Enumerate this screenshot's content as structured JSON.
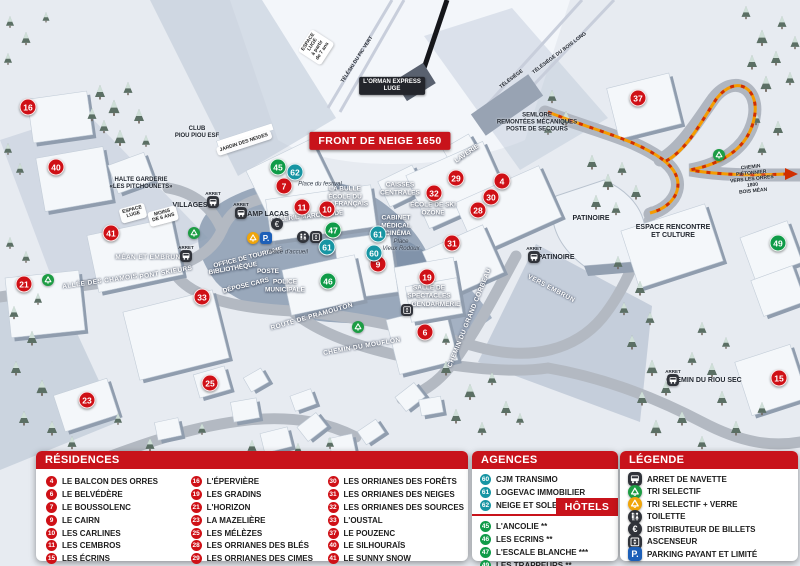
{
  "colors": {
    "red": "#c8131b",
    "marker_red": "#cf1016",
    "hotel_green": "#0f9b48",
    "agency_teal": "#1795a3",
    "parking_blue": "#1c5fb8",
    "recycle_orange": "#f0a50a",
    "path_orange": "#f59b00",
    "path_red": "#d02f00"
  },
  "map": {
    "banner": "FRONT DE NEIGE 1650",
    "markers": [
      [
        16,
        "r",
        28,
        107
      ],
      [
        40,
        "r",
        56,
        167
      ],
      [
        41,
        "r",
        111,
        233
      ],
      [
        21,
        "r",
        24,
        284
      ],
      [
        33,
        "r",
        202,
        297
      ],
      [
        23,
        "r",
        87,
        400
      ],
      [
        25,
        "r",
        210,
        383
      ],
      [
        7,
        "r",
        284,
        186
      ],
      [
        11,
        "r",
        302,
        207
      ],
      [
        10,
        "r",
        327,
        209
      ],
      [
        9,
        "r",
        378,
        264
      ],
      [
        19,
        "r",
        427,
        277
      ],
      [
        6,
        "r",
        425,
        332
      ],
      [
        29,
        "r",
        456,
        178
      ],
      [
        32,
        "r",
        434,
        193
      ],
      [
        4,
        "r",
        502,
        181
      ],
      [
        30,
        "r",
        491,
        197
      ],
      [
        28,
        "r",
        478,
        210
      ],
      [
        31,
        "r",
        452,
        243
      ],
      [
        37,
        "r",
        638,
        98
      ],
      [
        15,
        "r",
        779,
        378
      ],
      [
        45,
        "h",
        278,
        167
      ],
      [
        47,
        "h",
        333,
        230
      ],
      [
        46,
        "h",
        328,
        281
      ],
      [
        49,
        "h",
        778,
        243
      ],
      [
        62,
        "a",
        295,
        172
      ],
      [
        61,
        "a",
        378,
        234
      ],
      [
        60,
        "a",
        374,
        253
      ],
      [
        61,
        "a",
        327,
        247
      ]
    ],
    "labels": [
      [
        "L'ORMAN EXPRESS\nLUGE",
        392,
        86,
        0,
        "darkchip"
      ],
      [
        "TÉLÉSKI DU PIC VERT",
        358,
        60,
        -57,
        "dark5"
      ],
      [
        "ESPACE\nLUGE\nà partir\nde 7 ans",
        316,
        47,
        -57,
        "chip"
      ],
      [
        "TÉLÉSIÈGE",
        512,
        80,
        -37,
        "dark5"
      ],
      [
        "TÉLÉSIÈGE DU BOIS LONG",
        560,
        54,
        -37,
        "dark5"
      ],
      [
        "CLUB\nPIOU PIOU ESF",
        197,
        133,
        0,
        "dark6"
      ],
      [
        "JARDIN DES NEIGES",
        244,
        143,
        -18,
        "chip"
      ],
      [
        "HALTE GARDERIE\n«LES PITCHOUNETS»",
        141,
        184,
        0,
        "dark6"
      ],
      [
        "VILLAGES",
        190,
        206,
        0,
        "dark7"
      ],
      [
        "CHAMP LACAS",
        263,
        215,
        0,
        "dark7"
      ],
      [
        "Place du festival",
        320,
        185,
        0,
        "italic"
      ],
      [
        "LA BULLE\nÉCOLE DU\nSKI FRANÇAIS",
        345,
        197,
        0,
        "place"
      ],
      [
        "GALERIE MARCHANDE",
        307,
        217,
        -6,
        "place"
      ],
      [
        "CAISSES\nCENTRALES",
        400,
        189,
        0,
        "place"
      ],
      [
        "LAVERIE",
        467,
        154,
        -35,
        "place"
      ],
      [
        "ÉCOLE DE SKI\nOZONE",
        433,
        209,
        0,
        "place"
      ],
      [
        "CABINET\nMÉDICAL",
        396,
        222,
        0,
        "place"
      ],
      [
        "CINÉMA",
        398,
        234,
        0,
        "place"
      ],
      [
        "Place\nVieux Rodoux",
        401,
        246,
        0,
        "italic"
      ],
      [
        "OFFICE DE TOURISME",
        248,
        258,
        -14,
        "place"
      ],
      [
        "BIBLIOTHÈQUE",
        233,
        269,
        -10,
        "place"
      ],
      [
        "POSTE",
        268,
        272,
        0,
        "place"
      ],
      [
        "DÉPOSE CARS",
        246,
        286,
        -14,
        "place"
      ],
      [
        "POLICE\nMUNICIPALE",
        285,
        286,
        0,
        "place"
      ],
      [
        "Place d'accueil",
        288,
        253,
        0,
        "italic"
      ],
      [
        "SALLE DE\nSPECTACLES",
        429,
        292,
        0,
        "place"
      ],
      [
        "GENDARMERIE",
        436,
        305,
        0,
        "place"
      ],
      [
        "MÉAN ET EMBRUN",
        148,
        258,
        0,
        "road"
      ],
      [
        "PONT SKIEURS",
        166,
        273,
        -10,
        "road"
      ],
      [
        "ALLÉE DES CHAMOIS",
        100,
        282,
        -8,
        "road"
      ],
      [
        "ROUTE DE PRAMOUTON",
        312,
        317,
        -16,
        "road"
      ],
      [
        "CHEMIN DU MOUFLON",
        362,
        347,
        -10,
        "road"
      ],
      [
        "CHEMIN DU GRAND CORBEAU",
        470,
        318,
        -68,
        "road"
      ],
      [
        "VERS EMBRUN",
        551,
        289,
        28,
        "road"
      ],
      [
        "SEMLORE\nREMONTÉES MÉCANIQUES\nPOSTE DE SECOURS",
        537,
        123,
        0,
        "dark6"
      ],
      [
        "PATINOIRE",
        591,
        219,
        0,
        "dark7"
      ],
      [
        "PATINOIRE",
        556,
        258,
        0,
        "dark7"
      ],
      [
        "ESPACE RENCONTRE\nET CULTURE",
        673,
        232,
        0,
        "dark7"
      ],
      [
        "CHEMIN PIÉTONNIER\nVERS LES ORRES 1800\nBOIS MÉAN",
        752,
        180,
        -6,
        "dark5"
      ],
      [
        "CHEMIN DU RIOU SEC",
        704,
        381,
        0,
        "dark7"
      ],
      [
        "ESPACE\nLUGE",
        133,
        213,
        -15,
        "chip"
      ],
      [
        "MOINS\nDE 6 ANS",
        163,
        216,
        -15,
        "chip"
      ]
    ],
    "icons": [
      [
        "bus",
        213,
        202,
        "ARRET"
      ],
      [
        "bus",
        241,
        213,
        "ARRET"
      ],
      [
        "bus",
        186,
        256,
        "ARRET"
      ],
      [
        "bus",
        534,
        257,
        "ARRET"
      ],
      [
        "bus",
        673,
        380,
        "ARRET"
      ],
      [
        "recycle-green",
        194,
        233
      ],
      [
        "recycle-green",
        48,
        280
      ],
      [
        "recycle-green",
        719,
        155
      ],
      [
        "recycle-green",
        358,
        327
      ],
      [
        "recycle-orange",
        253,
        238
      ],
      [
        "parking",
        266,
        238
      ],
      [
        "euro",
        277,
        224
      ],
      [
        "toilet",
        303,
        237
      ],
      [
        "elevator",
        316,
        237
      ],
      [
        "elevator",
        407,
        310
      ]
    ]
  },
  "panels": {
    "residences": {
      "title": "RÉSIDENCES",
      "columns": [
        [
          [
            4,
            "LE BALCON DES ORRES"
          ],
          [
            6,
            "LE BELVÉDÈRE"
          ],
          [
            7,
            "LE BOUSSOLENC"
          ],
          [
            9,
            "LE CAIRN"
          ],
          [
            10,
            "LES CARLINES"
          ],
          [
            11,
            "LES CEMBROS"
          ],
          [
            15,
            "LES ÉCRINS"
          ]
        ],
        [
          [
            16,
            "L'ÉPERVIÈRE"
          ],
          [
            19,
            "LES GRADINS"
          ],
          [
            21,
            "L'HORIZON"
          ],
          [
            23,
            "LA MAZELIÈRE"
          ],
          [
            25,
            "LES MÉLÈZES"
          ],
          [
            28,
            "LES ORRIANES DES BLÉS"
          ],
          [
            29,
            "LES ORRIANES DES CIMES"
          ]
        ],
        [
          [
            30,
            "LES ORRIANES DES FORÊTS"
          ],
          [
            31,
            "LES ORRIANES DES NEIGES"
          ],
          [
            32,
            "LES ORRIANES DES SOURCES"
          ],
          [
            33,
            "L'OUSTAL"
          ],
          [
            37,
            "LE POUZENC"
          ],
          [
            40,
            "LE SILHOURAÏS"
          ],
          [
            41,
            "LE SUNNY SNOW"
          ]
        ]
      ]
    },
    "agences": {
      "title": "AGENCES IMMOBILIÈRES",
      "items": [
        [
          60,
          "CJM TRANSIMO"
        ],
        [
          61,
          "LOGEVAC IMMOBILIER"
        ],
        [
          62,
          "NEIGE ET SOLEIL"
        ]
      ]
    },
    "hotels": {
      "title": "HÔTELS",
      "items": [
        [
          45,
          "L'ANCOLIE **"
        ],
        [
          46,
          "LES ECRINS **"
        ],
        [
          47,
          "L'ESCALE BLANCHE ***"
        ],
        [
          49,
          "LES TRAPPEURS **"
        ]
      ]
    },
    "legende": {
      "title": "LÉGENDE",
      "items": [
        [
          "bus",
          "ARRET DE NAVETTE"
        ],
        [
          "recycle-green",
          "TRI SELECTIF"
        ],
        [
          "recycle-orange",
          "TRI SELECTIF + VERRE"
        ],
        [
          "toilet",
          "TOILETTE"
        ],
        [
          "euro",
          "DISTRIBUTEUR DE BILLETS"
        ],
        [
          "elevator",
          "ASCENSEUR"
        ],
        [
          "parking",
          "PARKING PAYANT ET LIMITÉ"
        ]
      ]
    }
  }
}
